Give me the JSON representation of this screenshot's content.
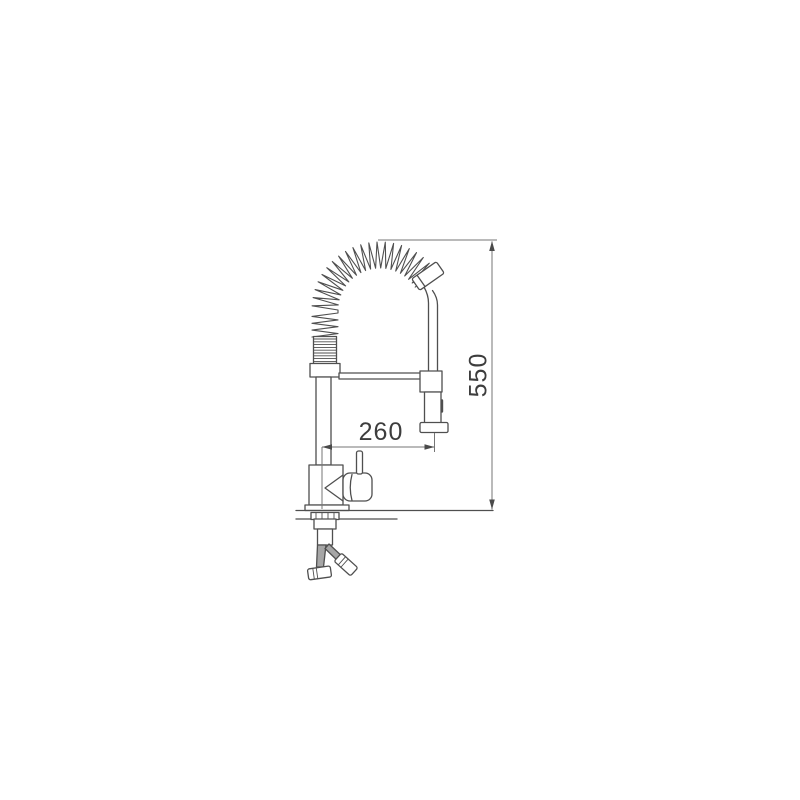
{
  "diagram": {
    "type": "faucet-technical-drawing",
    "labels": {
      "reach": "260",
      "height": "550"
    },
    "colors": {
      "line": "#4f4f4f",
      "dimension": "#757575",
      "arrow": "#4a4a4a",
      "text": "#3d3d3d",
      "hose": "#a6a6a6",
      "background": "#ffffff"
    }
  }
}
